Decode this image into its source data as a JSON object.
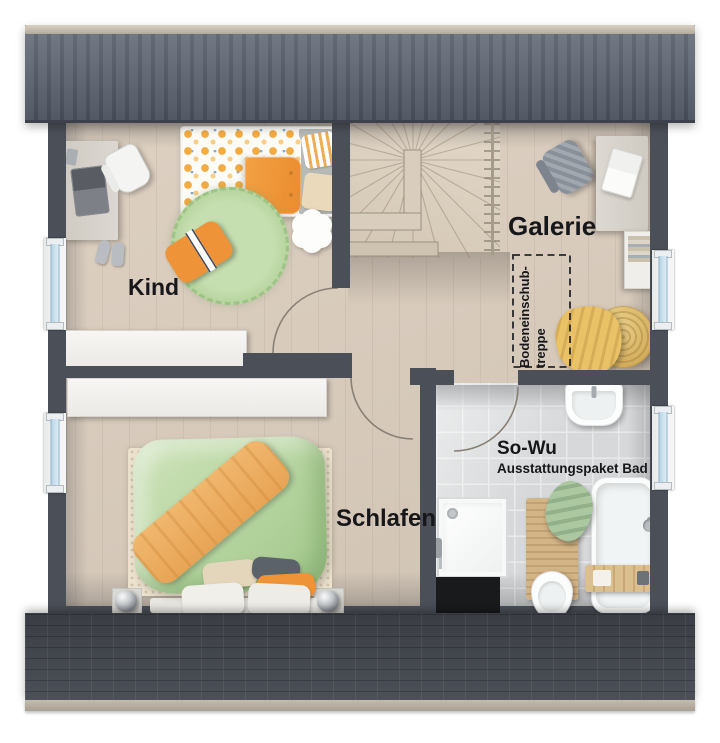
{
  "rooms": {
    "kind": {
      "label": "Kind"
    },
    "galerie": {
      "label": "Galerie"
    },
    "schlafen": {
      "label": "Schlafen"
    },
    "bad": {
      "label": "So-Wu",
      "sublabel": "Ausstattungspaket Bad"
    }
  },
  "annotations": {
    "attic_hatch_line1": "Bodeneinschub-",
    "attic_hatch_line2": "treppe"
  },
  "palette": {
    "roof_top": "#5e6573",
    "roof_bottom": "#43474f",
    "ridge": "#c3bcae",
    "wall": "#4b4f58",
    "floor_wood": "#d6c9ba",
    "bath_tile": "#d6d8d9",
    "accent_orange": "#ef9338",
    "accent_green": "#b5d49f",
    "accent_yellow": "#e9c167",
    "window_glass": "#c5dcEB"
  }
}
